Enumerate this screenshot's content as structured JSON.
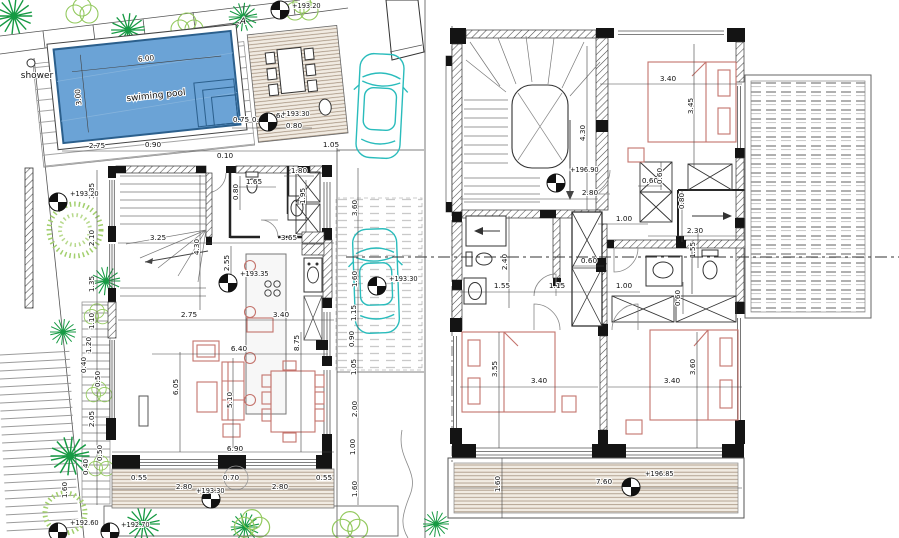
{
  "labels": {
    "shower": "shower",
    "pool": "swiming pool",
    "pool_len": "6.00",
    "pool_wid": "3.00",
    "section": "A"
  },
  "levels": {
    "a1": "+193.20",
    "a2": "+193.30",
    "a3": "+193.20",
    "a4": "+193.35",
    "a5": "+193.30",
    "a6": "+193.30",
    "a7": "+192.60",
    "a8": "+192.70",
    "b1": "+196.90",
    "b2": "+196.85"
  },
  "ld": {
    "top1": "2.75",
    "top2": "0.90",
    "top3": "0.10",
    "top4": "0.75",
    "top5": "0.80",
    "top6": "0.60",
    "top7": "0.80",
    "top8": "1.05",
    "l1": "1.35",
    "l2": "2.10",
    "l3": "1.35",
    "l4": "1.10",
    "l5": "1.20",
    "l6": "0.40",
    "l7": "0.50",
    "l8": "2.05",
    "l9": "0.50",
    "l10": "0.40",
    "l11": "1.60",
    "wc1": "1.65",
    "wc2": "0.80",
    "wc3": "1.80",
    "wc4": "1.95",
    "in1": "3.25",
    "in2": "4.30",
    "in3": "3.65",
    "in4": "2.55",
    "in5": "2.75",
    "in6": "3.40",
    "in7": "6.40",
    "in8": "6.05",
    "in9": "5.10",
    "in10": "8.75",
    "in11": "6.90",
    "b1": "0.55",
    "b2": "2.80",
    "b3": "0.70",
    "b4": "2.80",
    "b5": "0.55",
    "r1": "3.60",
    "r2": "1.60",
    "r3": "1.15",
    "r4": "0.90",
    "r5": "1.05",
    "r6": "2.00",
    "r7": "1.00",
    "r8": "1.60"
  },
  "rd": {
    "t1": "3.40",
    "t2": "3.45",
    "t3": "4.30",
    "t4": "2.80",
    "m1": "0.60",
    "m2": "0.60",
    "m3": "1.00",
    "m4": "0.80",
    "m5": "2.30",
    "m6": "1.55",
    "m7": "2.40",
    "m8": "1.55",
    "m9": "1.15",
    "m10": "1.00",
    "m11": "0.60",
    "m12": "0.60",
    "b1": "3.55",
    "b2": "3.40",
    "b3": "3.40",
    "b4": "3.60",
    "b5": "1.60",
    "b6": "7.60"
  },
  "colors": {
    "pool_fill": "#6ba3d6",
    "pool_edge": "#2b5f8c",
    "furniture": "#c4736c",
    "vegetation_dark": "#169a43",
    "vegetation_light": "#93c95e",
    "car": "#2abcbc",
    "wall": "#141414",
    "deck": "#a5927f"
  }
}
